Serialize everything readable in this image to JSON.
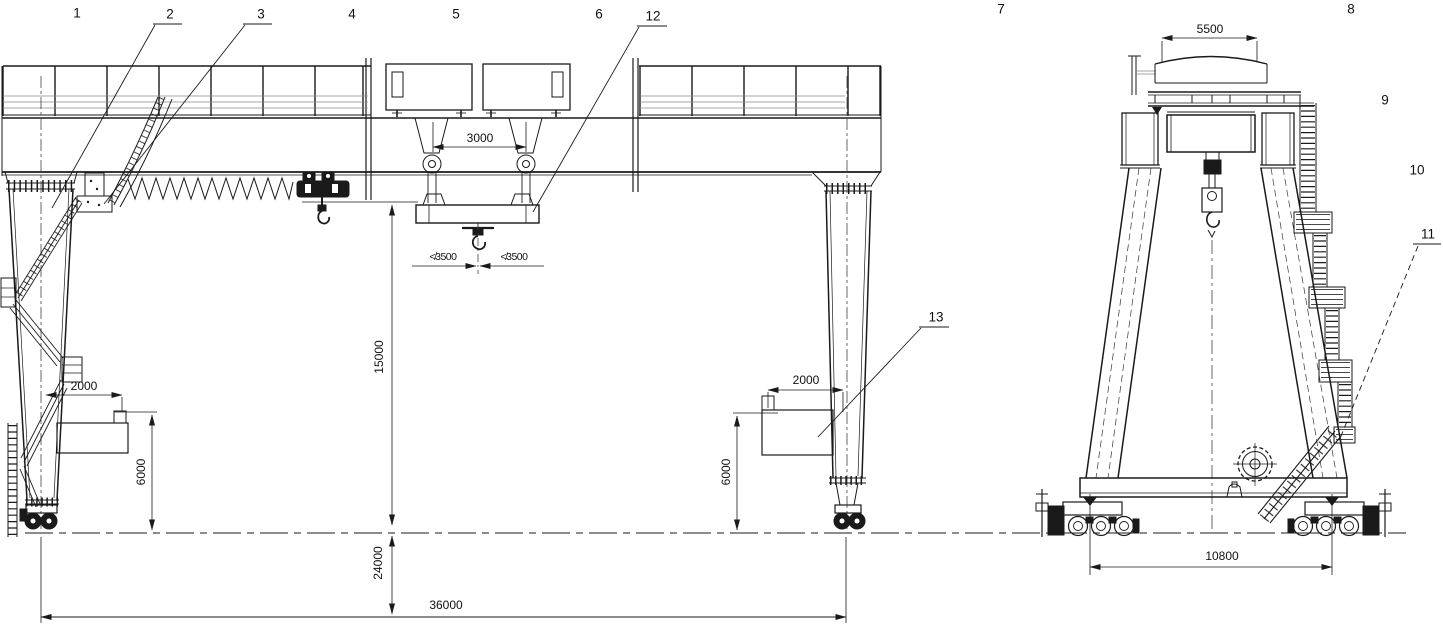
{
  "drawing": {
    "description": "General arrangement drawing of a double girder gantry crane, front elevation (left) and side elevation (right)",
    "background_color": "#ffffff",
    "line_color": "#1a1a1a"
  },
  "part_numbers": {
    "n1": "1",
    "n2": "2",
    "n3": "3",
    "n4": "4",
    "n5": "5",
    "n6": "6",
    "n7": "7",
    "n8": "8",
    "n9": "9",
    "n10": "10",
    "n11": "11",
    "n12": "12",
    "n13": "13"
  },
  "dimensions": {
    "trolley_rope_gauge": "3000",
    "hook_side_left": "≮3500",
    "hook_side_right": "≮3500",
    "lifting_height": "15000",
    "below_rail_height": "24000",
    "span": "36000",
    "outreach_left": "2000",
    "outreach_right": "2000",
    "platform_height_left": "6000",
    "platform_height_right": "6000",
    "trolley_top_width": "5500",
    "bogie_wheelbase": "10800"
  }
}
